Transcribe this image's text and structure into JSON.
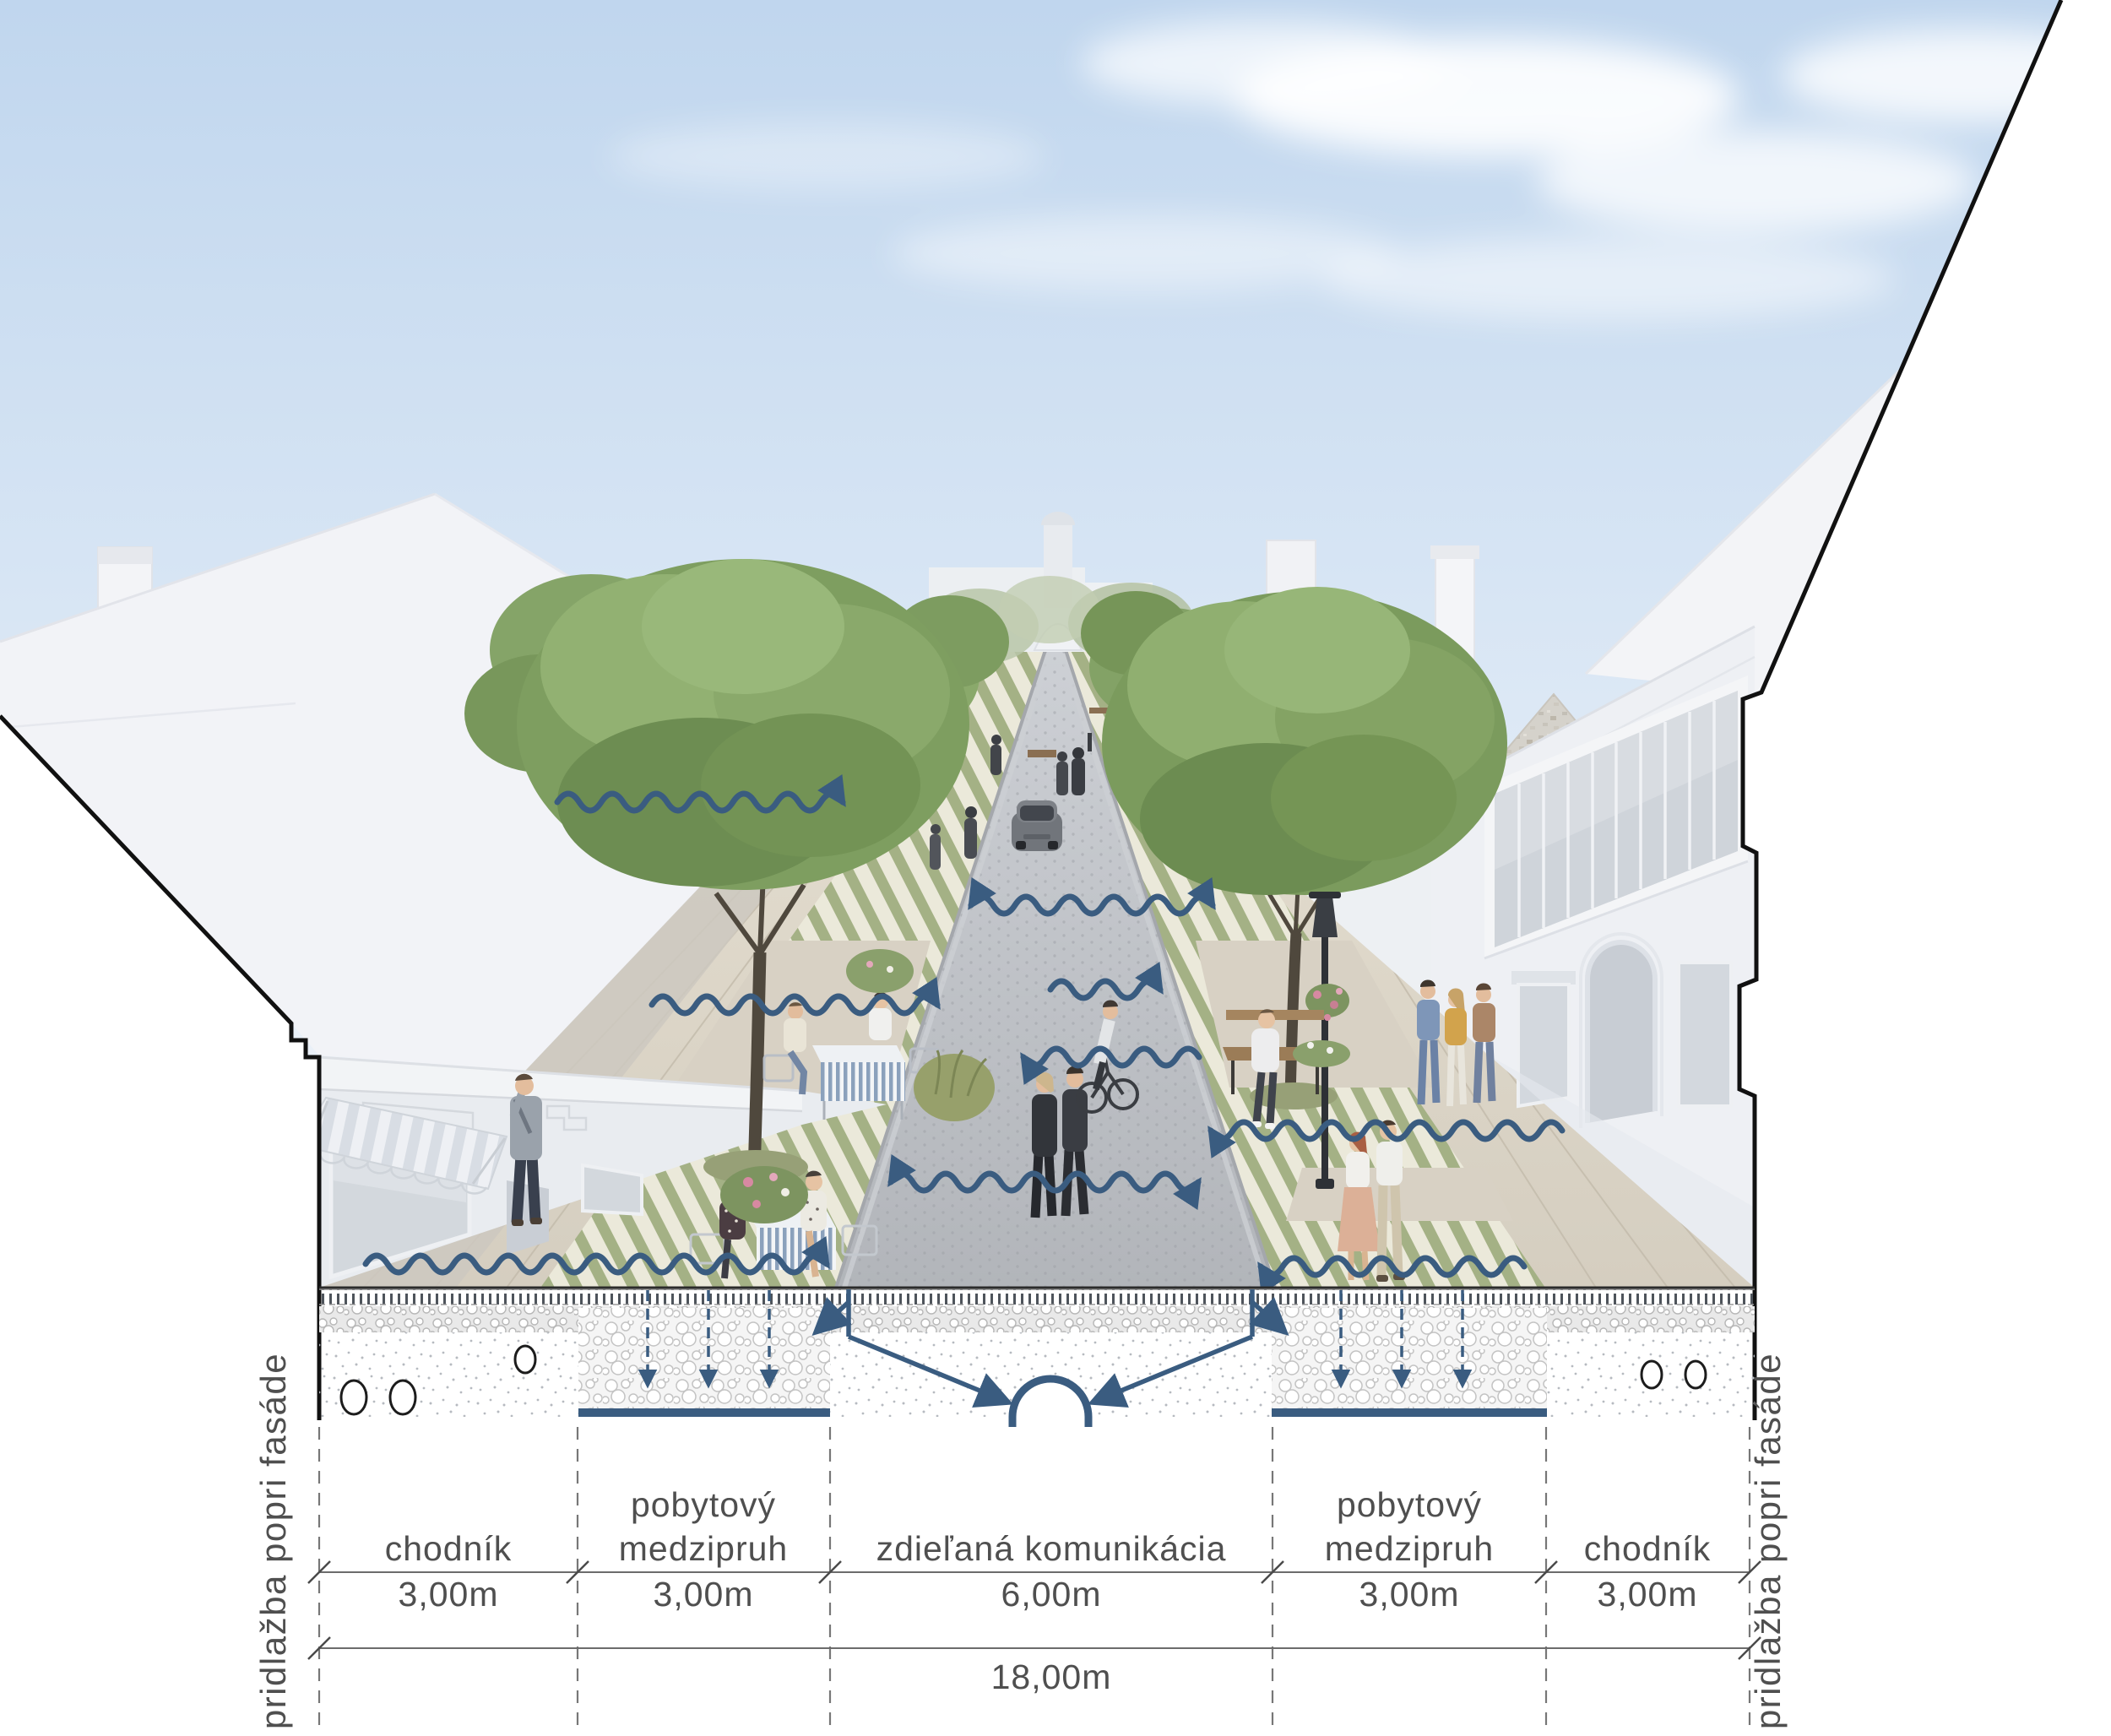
{
  "annotation": {
    "side_label_left": "pridlažba popri fasáde",
    "side_label_right": "pridlažba popri fasáde",
    "zones": [
      {
        "name": "chodník",
        "name_line2": "",
        "width": "3,00m"
      },
      {
        "name": "pobytový",
        "name_line2": "medzipruh",
        "width": "3,00m"
      },
      {
        "name": "zdieľaná komunikácia",
        "name_line2": "",
        "width": "6,00m"
      },
      {
        "name": "pobytový",
        "name_line2": "medzipruh",
        "width": "3,00m"
      },
      {
        "name": "chodník",
        "name_line2": "",
        "width": "3,00m"
      }
    ],
    "total_width": "18,00m"
  },
  "colors": {
    "accent_blue": "#3a5c80",
    "annotation_text": "#4f4f4f",
    "tree_green": "#7e9e60",
    "stripe_green": "#a4b185",
    "facade_white": "#edeff3",
    "road_grey": "#b9bcc1",
    "paving_beige": "#d8d1c4",
    "sky_blue": "#c2d7ee"
  }
}
